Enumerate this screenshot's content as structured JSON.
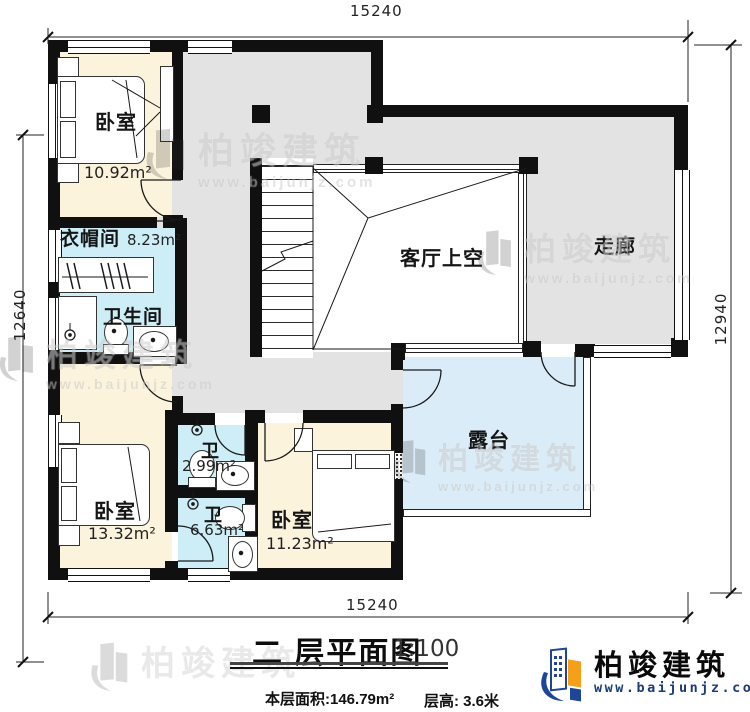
{
  "plan": {
    "rooms": {
      "bedroom_tl": {
        "label": "卧室",
        "area": "10.92m²"
      },
      "cloakroom": {
        "label": "衣帽间",
        "area": "8.23m²"
      },
      "bathroom": {
        "label": "卫生间"
      },
      "void": {
        "label": "客厅上空"
      },
      "corridor": {
        "label": "走廊"
      },
      "wc_small": {
        "label": "卫",
        "area": "2.99m²"
      },
      "wc_large": {
        "label": "卫",
        "area": "6.63m²"
      },
      "bedroom_bl": {
        "label": "卧室",
        "area": "13.32m²"
      },
      "bedroom_bc": {
        "label": "卧室",
        "area": "11.23m²"
      },
      "terrace": {
        "label": "露台"
      }
    },
    "dimensions": {
      "top": "15240",
      "bottom": "15240",
      "left": "12640",
      "right": "12940"
    }
  },
  "footer": {
    "title": "二 层平面图",
    "scale": "1:100",
    "floor_area": "本层面积:146.79m²",
    "floor_height": "层高: 3.6米"
  },
  "brand": {
    "name": "柏竣建筑",
    "url": "www.baijunjz.com"
  },
  "watermark": {
    "name": "柏竣建筑",
    "url": "www.baijunjz.com"
  },
  "colors": {
    "wall": "#101010",
    "bedroom_fill": "#fbf3dc",
    "wet_fill": "#cdeef6",
    "hall_fill": "#e3e3e3",
    "terrace_fill": "#daecf8",
    "logo_blue": "#1d4699",
    "logo_orange": "#f6a01a",
    "url_navy": "#1b3c77"
  }
}
